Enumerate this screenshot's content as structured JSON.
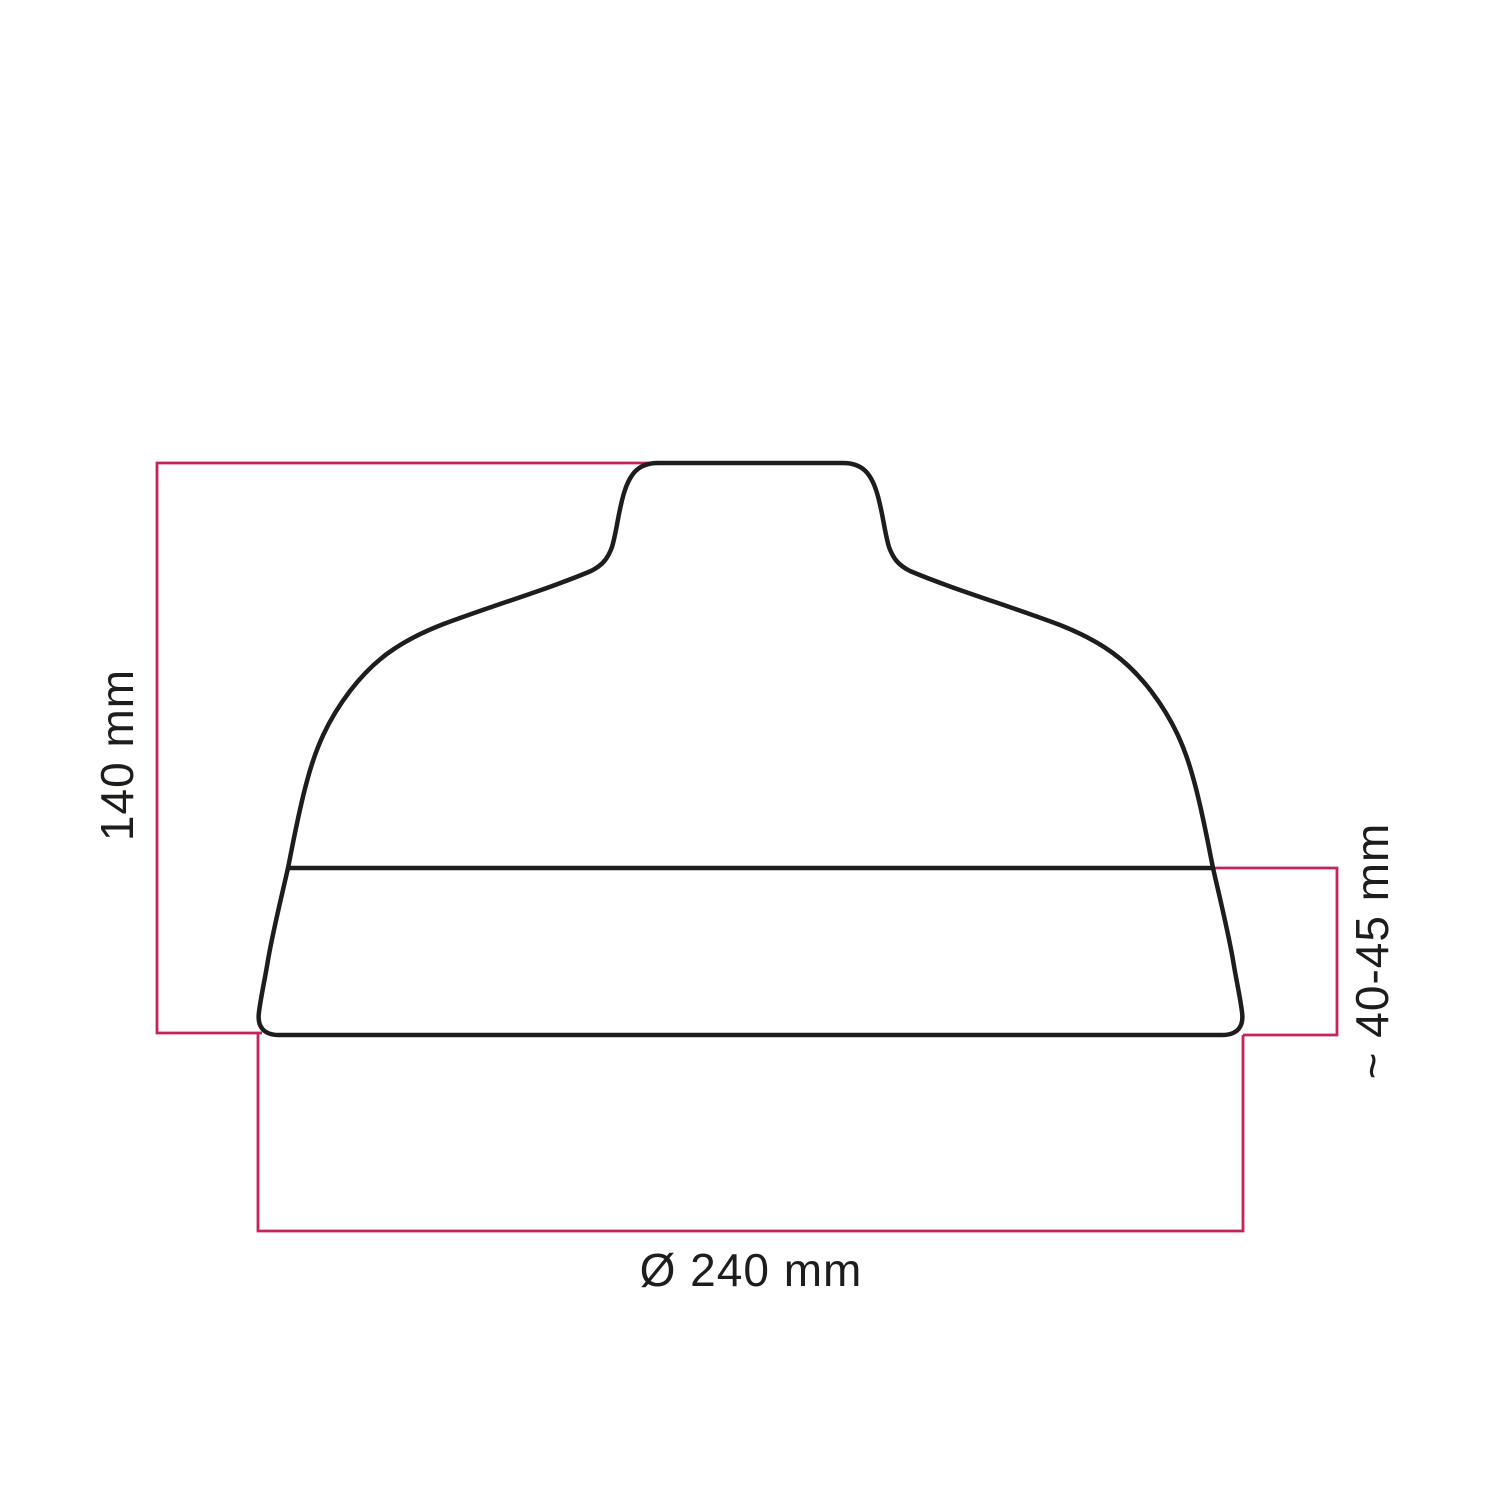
{
  "diagram": {
    "type": "technical-dimension-drawing",
    "subject": "lampshade-side-profile",
    "labels": {
      "height": "140 mm",
      "collar_height": "~ 40-45 mm",
      "diameter": "Ø 240 mm"
    },
    "colors": {
      "outline": "#1d1d1b",
      "dimension": "#c42457",
      "text": "#1d1d1b",
      "background": "#ffffff"
    }
  }
}
